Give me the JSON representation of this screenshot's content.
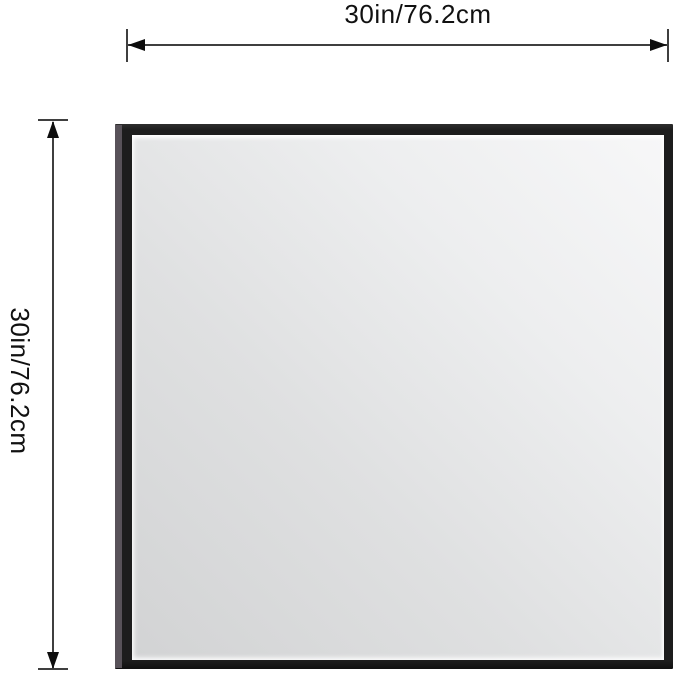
{
  "product_diagram": {
    "title": "framed square mirror dimension diagram",
    "width_dimension": {
      "label": "30in/76.2cm"
    },
    "height_dimension": {
      "label": "30in/76.2cm"
    }
  },
  "colors": {
    "background": "#ffffff",
    "frame": "#1d1d1d",
    "frame_top_edge": "#2e2e2e",
    "frame_side": "#585259",
    "glass_light": "#f7f7f8",
    "glass_dark": "#d2d3d4",
    "dimension_line": "#3f3f3f",
    "arrow": "#0d0d0d",
    "label_text": "#111111"
  }
}
